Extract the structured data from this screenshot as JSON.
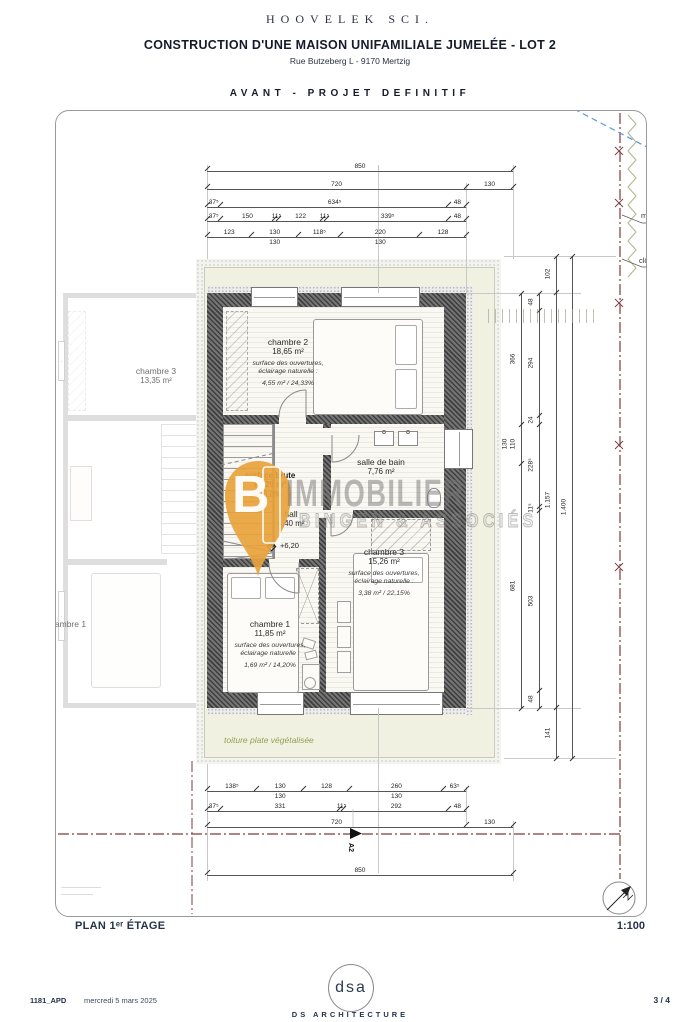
{
  "header": {
    "company": "HOOVELEK SCI.",
    "title": "CONSTRUCTION D'UNE MAISON UNIFAMILIALE JUMELÉE  -  LOT 2",
    "address": "Rue Butzeberg  L - 9170 Mertzig",
    "phase": "AVANT - PROJET DEFINITIF"
  },
  "plan": {
    "rooms": {
      "chambre2": {
        "name": "chambre 2",
        "area": "18,65 m²",
        "note_line1": "surface des ouvertures,",
        "note_line2": "éclairage naturelle :",
        "note_value": "4,55 m² / 24,33%"
      },
      "salle_de_bain": {
        "name": "salle de bain",
        "area": "7,76 m²"
      },
      "hall": {
        "name": "hall",
        "area": "4,40 m²"
      },
      "chambre3": {
        "name": "chambre 3",
        "area": "15,26 m²",
        "note_line1": "surface des ouvertures,",
        "note_line2": "éclairage naturelle :",
        "note_value": "3,38 m² / 22,15%"
      },
      "chambre1": {
        "name": "chambre 1",
        "area": "11,85 m²",
        "note_line1": "surface des ouvertures,",
        "note_line2": "éclairage naturelle :",
        "note_value": "1,69 m² / 14,20%"
      }
    },
    "surface_brute": {
      "label": "surface brute",
      "value": "83,29 m²",
      "percent": "70,0%"
    },
    "level": "+6,20",
    "roof": "toiture plate végétalisée",
    "adjacent_rooms": {
      "chambre3": {
        "name": "chambre 3",
        "area": "13,35 m²"
      },
      "chambre1": {
        "name": "chambre 1"
      }
    },
    "site": {
      "wall_label": "mur",
      "fence_label": "clôture",
      "section_marker": "A2"
    }
  },
  "dims": {
    "top": [
      [
        {
          "l": "850"
        }
      ],
      [
        {
          "l": "720"
        },
        {
          "l": "130"
        }
      ],
      [
        {
          "l": "37⁵"
        },
        {
          "l": "634⁵"
        },
        {
          "l": "48"
        }
      ],
      [
        {
          "l": "37⁵"
        },
        {
          "l": "150"
        },
        {
          "l": "11⁵"
        },
        {
          "l": "122"
        },
        {
          "l": "11⁵"
        },
        {
          "l": "339⁵"
        },
        {
          "l": "48"
        }
      ],
      [
        {
          "l": "123"
        },
        {
          "l": "130",
          "sub": "130"
        },
        {
          "l": "118⁵"
        },
        {
          "l": "220",
          "sub": "130"
        },
        {
          "l": "128"
        }
      ]
    ],
    "bottom": [
      [
        {
          "l": "138⁵"
        },
        {
          "l": "130",
          "sub": "130"
        },
        {
          "l": "128"
        },
        {
          "l": "260",
          "sub": "130"
        },
        {
          "l": "63⁵"
        }
      ],
      [
        {
          "l": "37⁵"
        },
        {
          "l": "331"
        },
        {
          "l": "11⁵"
        },
        {
          "l": "292"
        },
        {
          "l": "48"
        }
      ],
      [
        {
          "l": "720"
        },
        {
          "l": "130"
        }
      ],
      [
        {
          "l": "850"
        }
      ]
    ],
    "right": [
      [
        {
          "l": "366"
        },
        {
          "l": "110",
          "sub": "130"
        },
        {
          "l": "681"
        }
      ],
      [
        {
          "l": "48"
        },
        {
          "l": "294"
        },
        {
          "l": "24"
        },
        {
          "l": "228⁵"
        },
        {
          "l": "11⁵"
        },
        {
          "l": "503"
        },
        {
          "l": "48"
        }
      ],
      [
        {
          "l": "102"
        },
        {
          "l": "1.157"
        },
        {
          "l": "141"
        }
      ],
      [
        {
          "l": "1.400"
        }
      ]
    ]
  },
  "titleblock": {
    "title": "PLAN 1ᵉʳ ÉTAGE",
    "scale": "1:100"
  },
  "footer": {
    "ref": "1181_APD",
    "date": "mercredi 5 mars 2025",
    "logo_text": "dsa",
    "firm": "DS ARCHITECTURE",
    "page": "3 / 4"
  },
  "watermark": {
    "letter": "B",
    "brand": "IMMOBILIER",
    "subbrand": "BINGEN & ASSOCIÉS"
  },
  "colors": {
    "accent_orange": "#E8A33C",
    "boundary_red": "#7d3b3b",
    "hedge_green": "#a9b38b",
    "blue_line": "#5b9bd5",
    "navy": "#24324a",
    "roof_text_green": "#96a050"
  }
}
